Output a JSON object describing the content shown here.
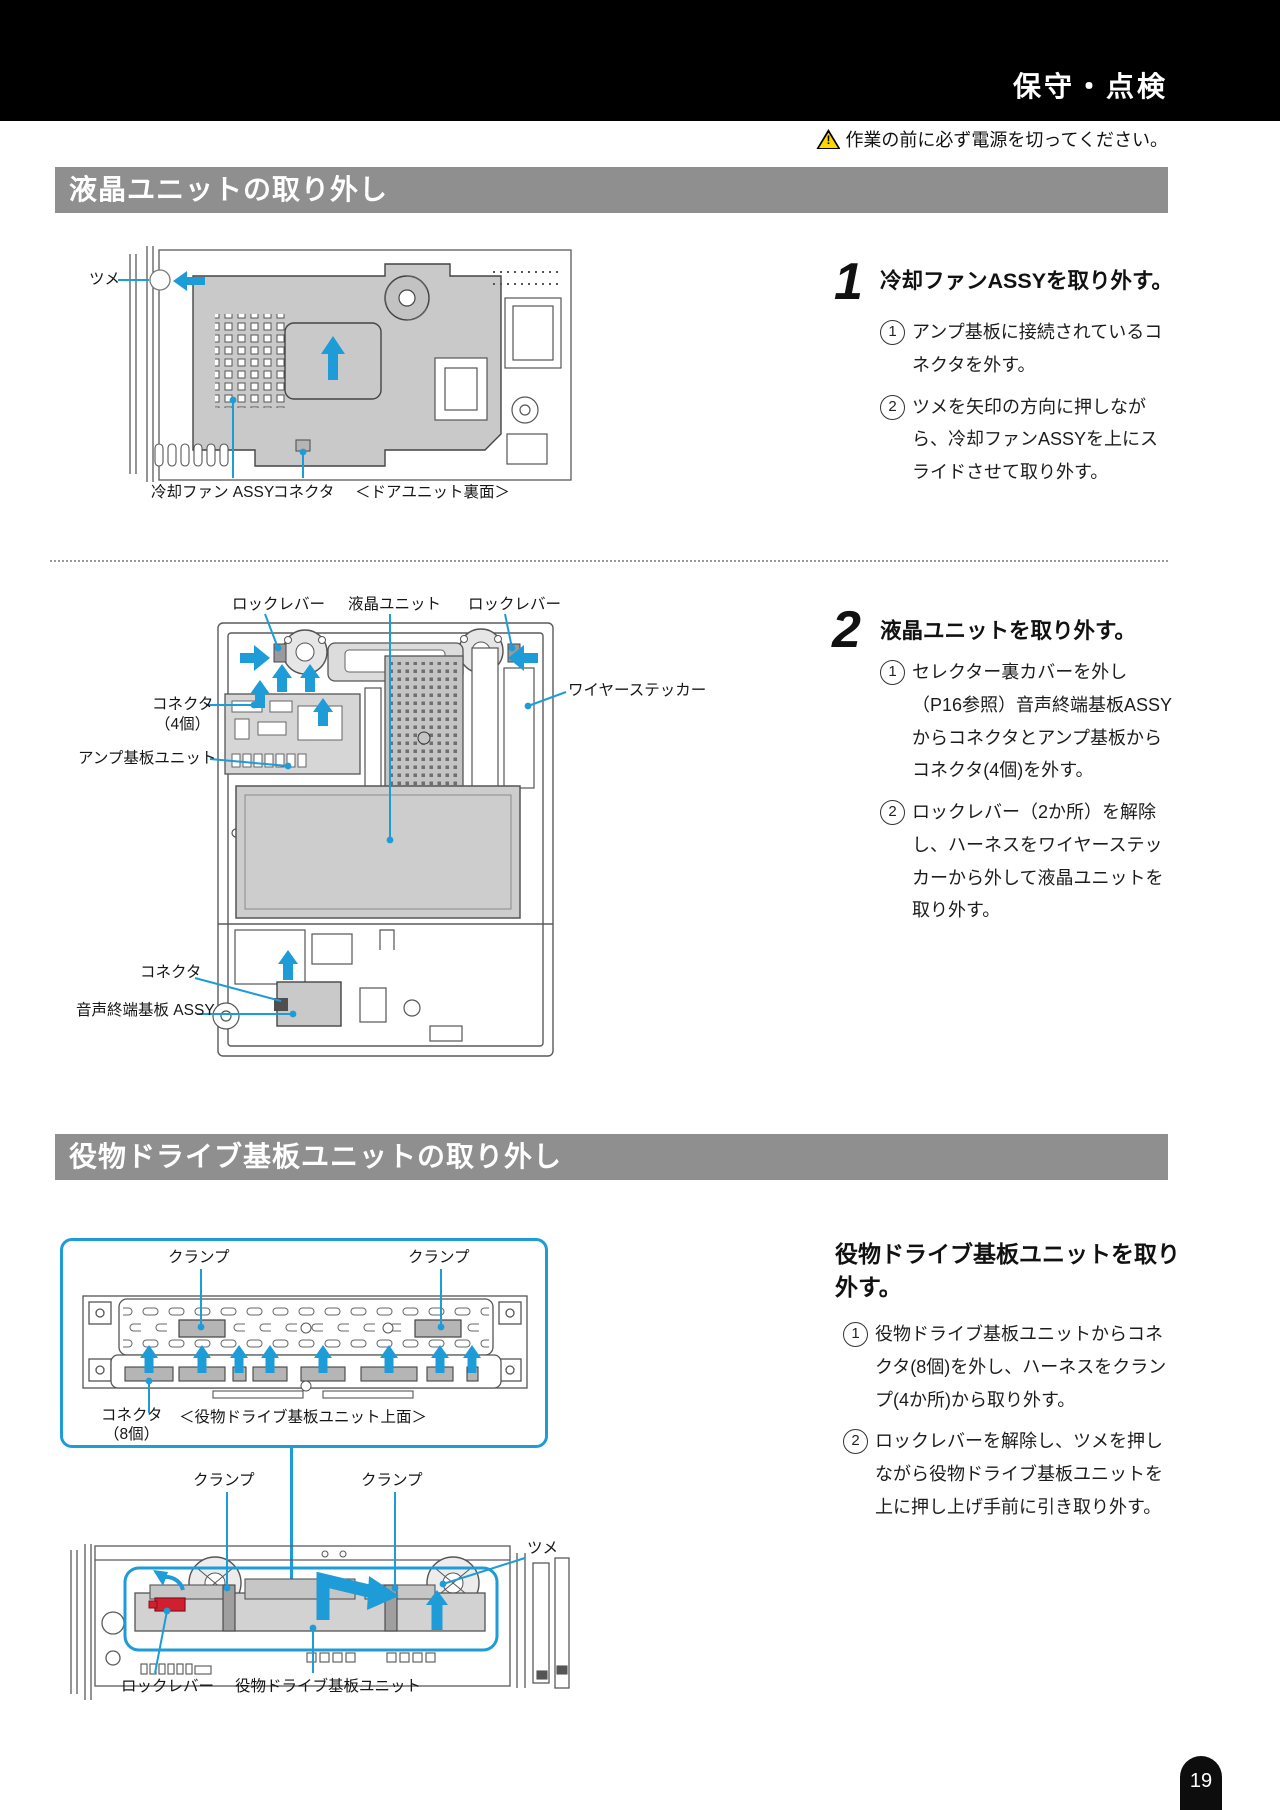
{
  "header": {
    "title": "保守・点検"
  },
  "warning": {
    "icon": "warning-triangle-icon",
    "text": "作業の前に必ず電源を切ってください。"
  },
  "sections": {
    "s1": {
      "title": "液晶ユニットの取り外し"
    },
    "s2": {
      "title": "役物ドライブ基板ユニットの取り外し"
    }
  },
  "steps": {
    "step1": {
      "num": "1",
      "title": "冷却ファンASSYを取り外す。",
      "items": [
        {
          "n": "1",
          "text": "アンプ基板に接続されているコネクタを外す。"
        },
        {
          "n": "2",
          "text": "ツメを矢印の方向に押しながら、冷却ファンASSYを上にスライドさせて取り外す。"
        }
      ]
    },
    "step2": {
      "num": "2",
      "title": "液晶ユニットを取り外す。",
      "items": [
        {
          "n": "1",
          "text": "セレクター裏カバーを外し（P16参照）音声終端基板ASSYからコネクタとアンプ基板からコネクタ(4個)を外す。"
        },
        {
          "n": "2",
          "text": "ロックレバー（2か所）を解除し、ハーネスをワイヤーステッカーから外して液晶ユニットを取り外す。"
        }
      ]
    },
    "step3": {
      "title": "役物ドライブ基板ユニットを取り外す。",
      "items": [
        {
          "n": "1",
          "text": "役物ドライブ基板ユニットからコネクタ(8個)を外し、ハーネスをクランプ(4か所)から取り外す。"
        },
        {
          "n": "2",
          "text": "ロックレバーを解除し、ツメを押しながら役物ドライブ基板ユニットを上に押し上げ手前に引き取り外す。"
        }
      ]
    }
  },
  "diagrams": {
    "d1": {
      "tsume": "ツメ",
      "fan_assy": "冷却ファン ASSY",
      "connector": "コネクタ",
      "caption": "＜ドアユニット裏面＞"
    },
    "d2": {
      "lock_lever_left": "ロックレバー",
      "lcd_unit": "液晶ユニット",
      "lock_lever_right": "ロックレバー",
      "wire_sticker": "ワイヤーステッカー",
      "connector": "コネクタ",
      "connector_count": "（4個）",
      "amp_board_unit": "アンプ基板ユニット",
      "connector2": "コネクタ",
      "audio_board": "音声終端基板 ASSY"
    },
    "d3": {
      "clamp_left": "クランプ",
      "clamp_right": "クランプ",
      "connector": "コネクタ",
      "connector_count": "（8個）",
      "caption": "＜役物ドライブ基板ユニット上面＞"
    },
    "d4": {
      "clamp_left": "クランプ",
      "clamp_right": "クランプ",
      "tsume": "ツメ",
      "lock_lever": "ロックレバー",
      "unit": "役物ドライブ基板ユニット"
    }
  },
  "colors": {
    "accent_blue": "#1e9cd7",
    "header_black": "#000000",
    "section_gray": "#8f8f8f",
    "warning_yellow": "#ffd600",
    "lock_red": "#d01f2f"
  },
  "page_number": "19"
}
